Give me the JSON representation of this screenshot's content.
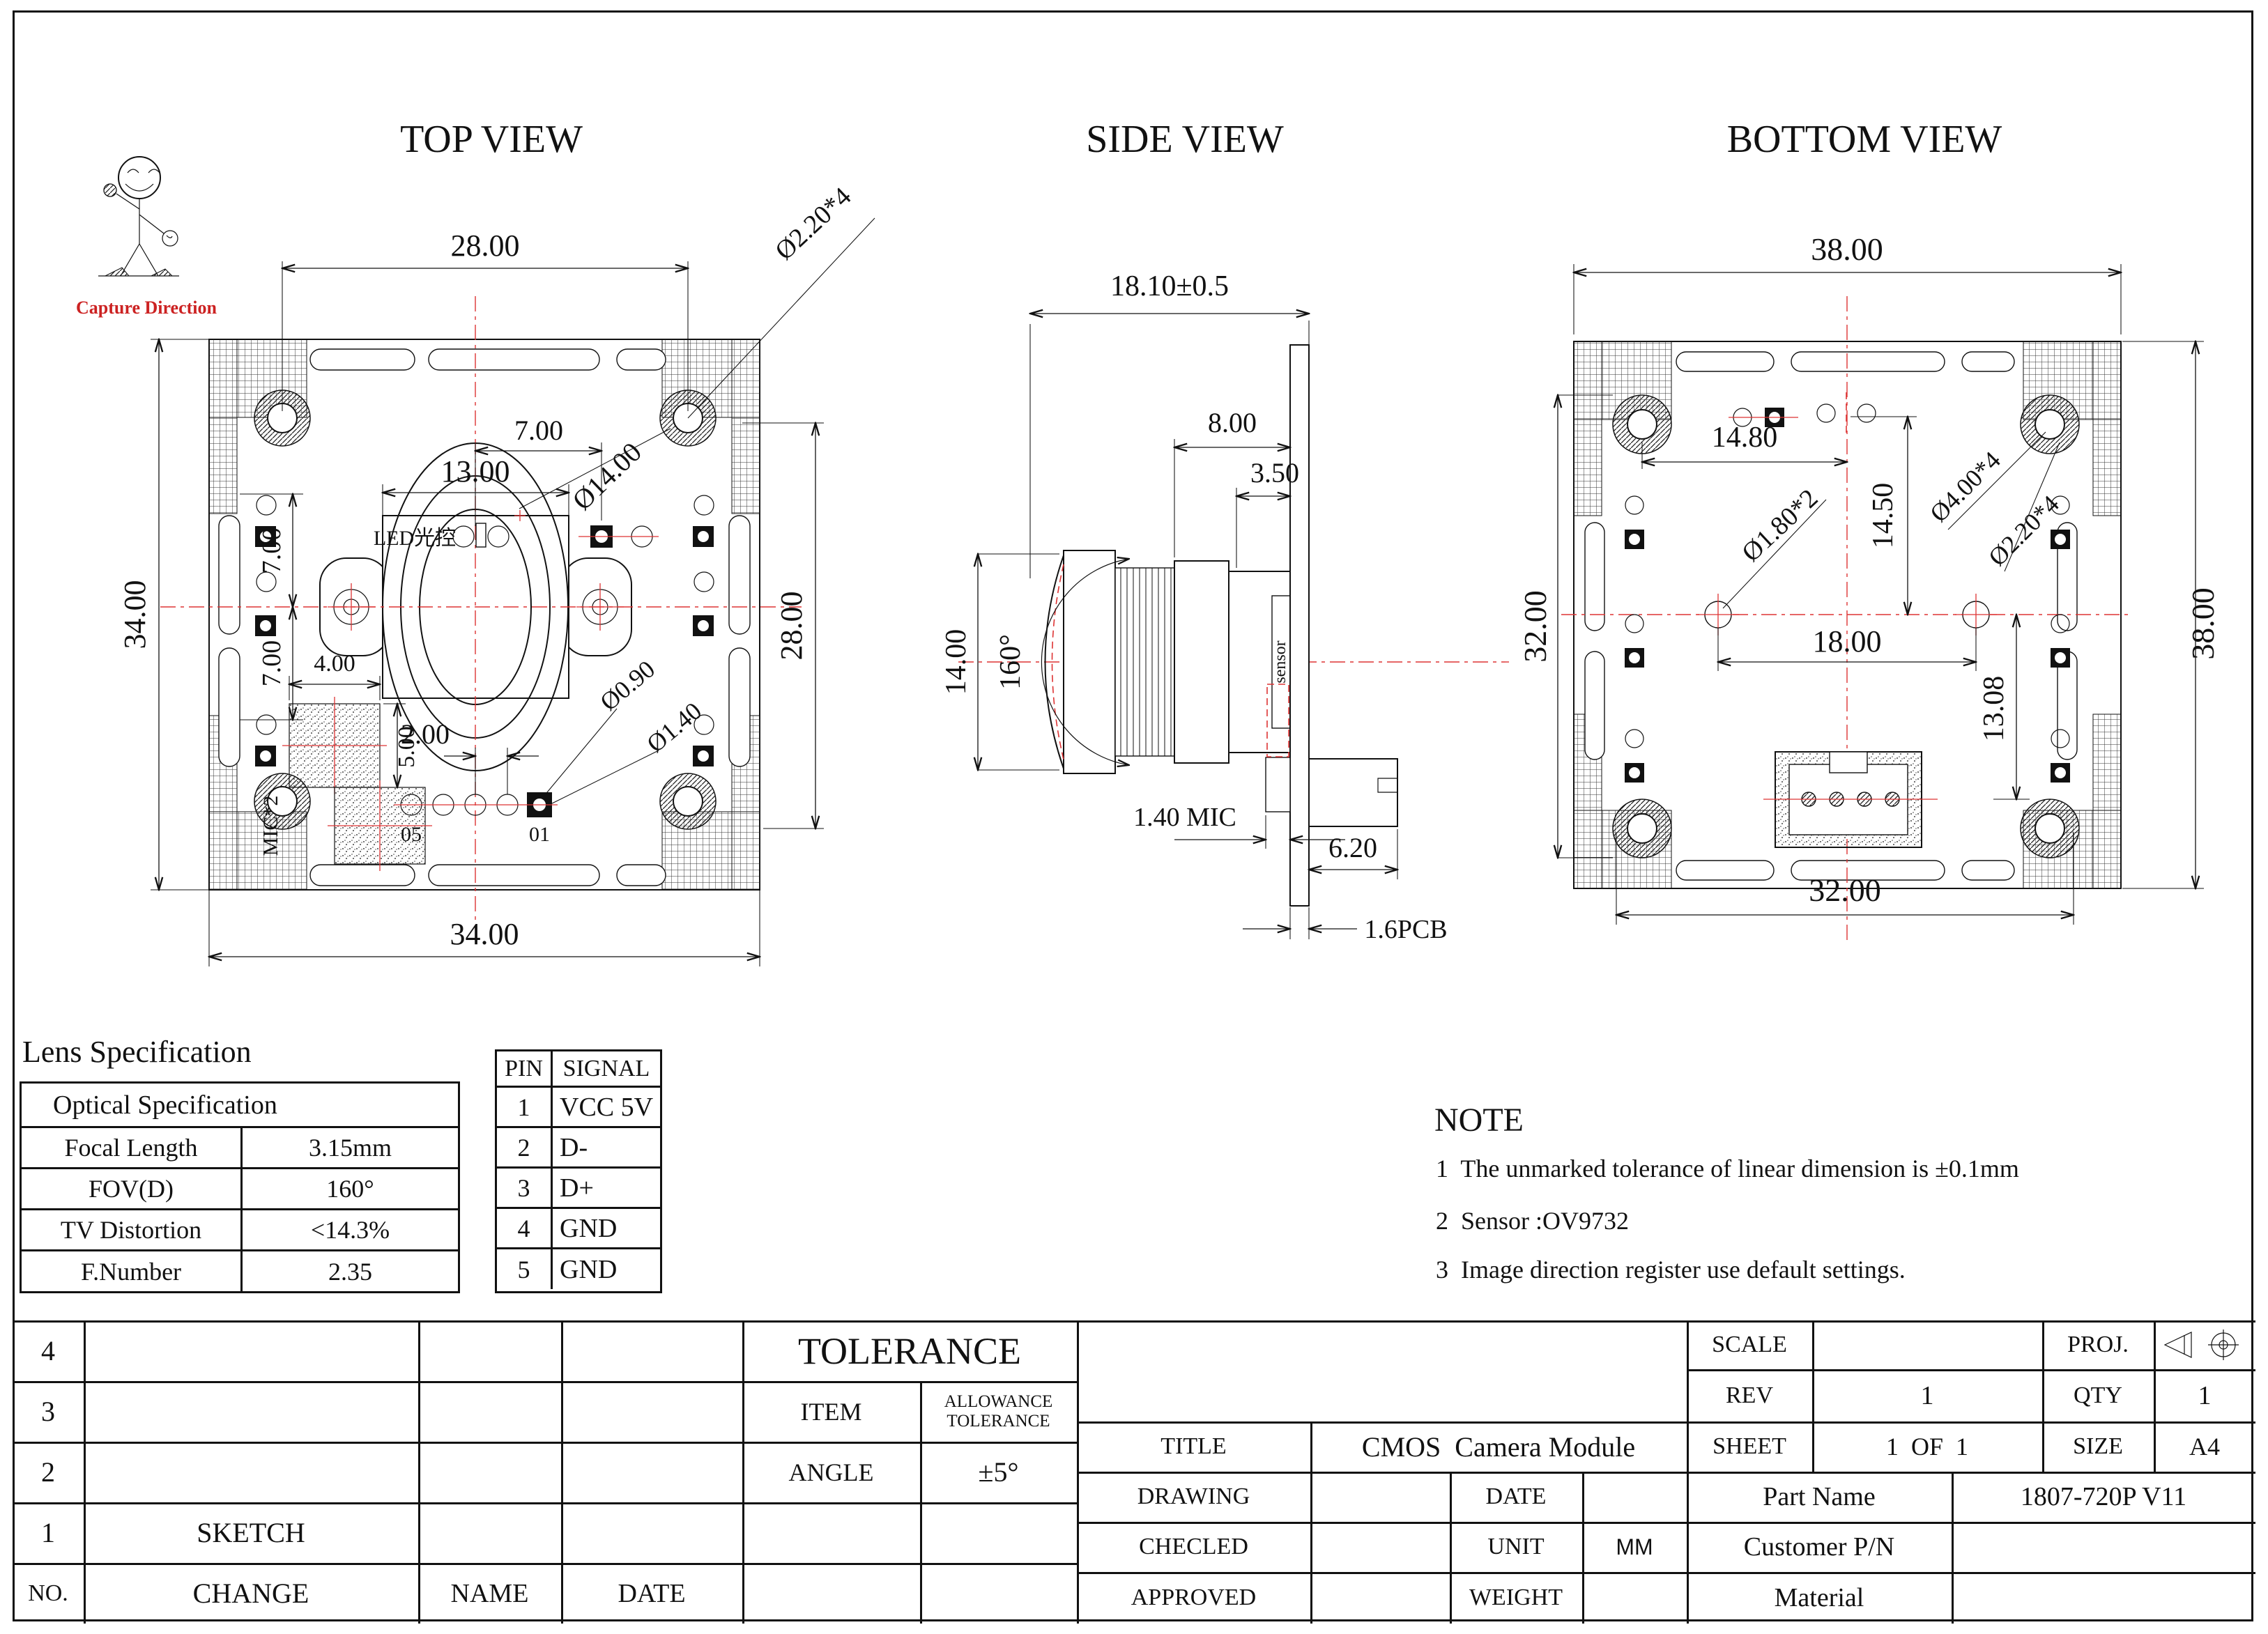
{
  "logo": {
    "caption": "Capture Direction"
  },
  "views": {
    "top": {
      "title": "TOP VIEW",
      "d": {
        "w28": "28.00",
        "hole": "Ø2.20*4",
        "led7": "7.00",
        "w13": "13.00",
        "lens14": "Ø14.00",
        "h34": "34.00",
        "u7": "7.00",
        "l7": "7.00",
        "mic4": "4.00",
        "mic5": "5.00",
        "pitch2": "2.00",
        "d09": "Ø0.90",
        "d14": "Ø1.40",
        "h28": "28.00",
        "w34": "34.00"
      },
      "t": {
        "led": "LED光控",
        "mic": "MIC*2",
        "p05": "05",
        "p01": "01"
      }
    },
    "side": {
      "title": "SIDE VIEW",
      "d": {
        "total": "18.10±0.5",
        "body8": "8.00",
        "f35": "3.50",
        "h14": "14.00",
        "fov": "160°",
        "mic": "1.40 MIC",
        "c62": "6.20",
        "pcb": "1.6PCB"
      },
      "t": {
        "sensor": "sensor"
      }
    },
    "bottom": {
      "title": "BOTTOM VIEW",
      "d": {
        "w38": "38.00",
        "s148": "14.80",
        "v145": "14.50",
        "fid": "Ø1.80*2",
        "mnt": "Ø4.00*4",
        "via": "Ø2.20*4",
        "s18": "18.00",
        "v1308": "13.08",
        "h32": "32.00",
        "h38": "38.00",
        "w32": "32.00"
      }
    }
  },
  "lens_spec": {
    "heading": "Lens Specification",
    "table_title": "Optical Specification",
    "rows": [
      [
        "Focal Length",
        "3.15mm"
      ],
      [
        "FOV(D)",
        "160°"
      ],
      [
        "TV Distortion",
        "<14.3%"
      ],
      [
        "F.Number",
        "2.35"
      ]
    ]
  },
  "pin_table": {
    "headers": [
      "PIN",
      "SIGNAL"
    ],
    "rows": [
      [
        "1",
        "VCC 5V"
      ],
      [
        "2",
        "D-"
      ],
      [
        "3",
        "D+"
      ],
      [
        "4",
        "GND"
      ],
      [
        "5",
        "GND"
      ]
    ]
  },
  "note": {
    "heading": "NOTE",
    "items": [
      "1  The unmarked tolerance of linear dimension is ±0.1mm",
      "2  Sensor :OV9732",
      "3  Image direction register use default settings."
    ]
  },
  "title_block": {
    "rev_rows": [
      "4",
      "3",
      "2",
      "1"
    ],
    "no": "NO.",
    "sketch": "SKETCH",
    "change": "CHANGE",
    "name": "NAME",
    "date": "DATE",
    "tolerance": "TOLERANCE",
    "item": "ITEM",
    "allowance_line1": "ALLOWANCE",
    "allowance_line2": "TOLERANCE",
    "angle": "ANGLE",
    "angle_val": "±5°",
    "scale": "SCALE",
    "proj": "PROJ.",
    "rev": "REV",
    "rev_val": "1",
    "qty": "QTY",
    "qty_val": "1",
    "title": "TITLE",
    "title_val": "CMOS  Camera Module",
    "sheet": "SHEET",
    "sheet_val": "1  OF  1",
    "size": "SIZE",
    "size_val": "A4",
    "drawing": "DRAWING",
    "date_label": "DATE",
    "part_name": "Part Name",
    "part_val": "1807-720P V11",
    "checked": "CHECLED",
    "unit": "UNIT",
    "unit_val": "MM",
    "customer": "Customer P/N",
    "approved": "APPROVED",
    "weight": "WEIGHT",
    "material": "Material"
  }
}
